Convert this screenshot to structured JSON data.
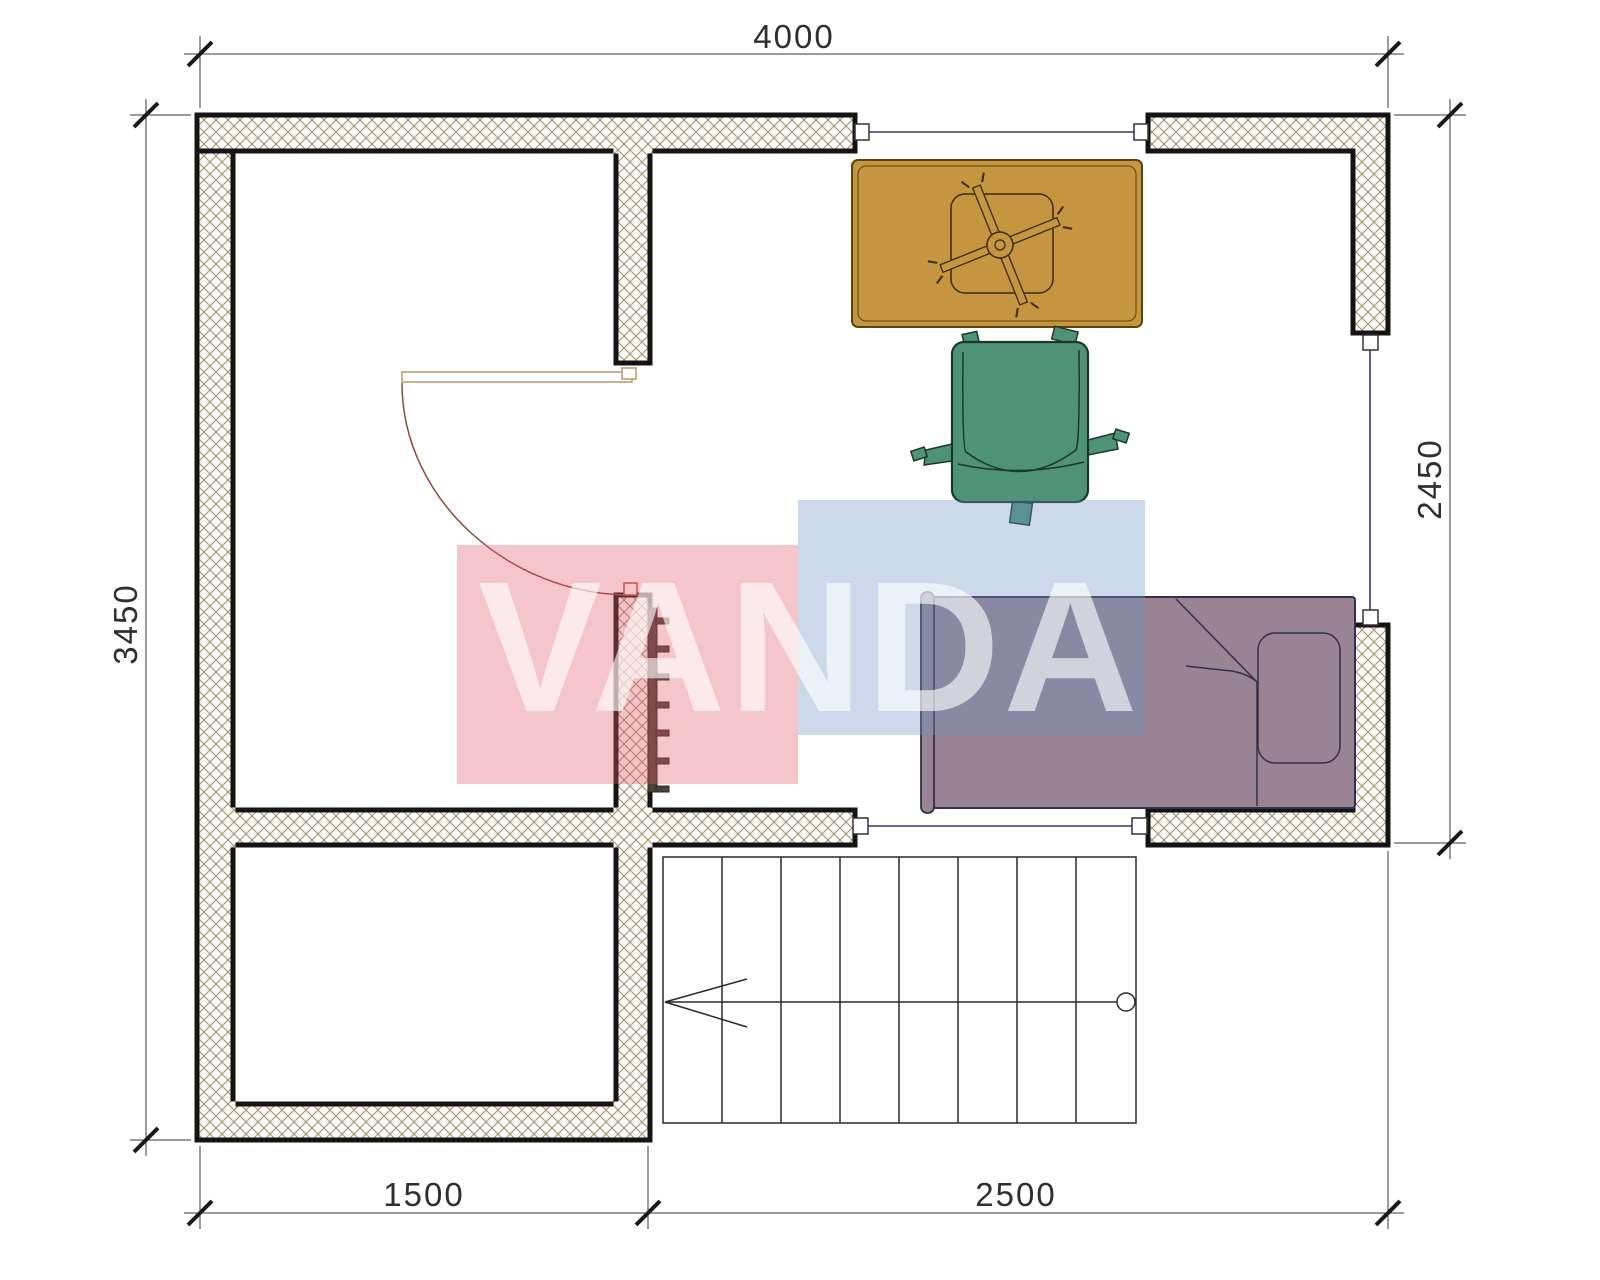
{
  "plan": {
    "type": "floor-plan",
    "dimensions": {
      "top": "4000",
      "left": "3450",
      "right": "2450",
      "bottom_left": "1500",
      "bottom_right": "2500"
    },
    "stairs": {
      "treads": 8
    },
    "windows_count": 3,
    "doors_count": 1,
    "furniture": [
      "desk",
      "office-chair",
      "armchair",
      "single-bed",
      "radiator",
      "staircase"
    ]
  },
  "watermark": {
    "text": "VANDA"
  },
  "colors": {
    "wall_line": "#141414",
    "hatch_line": "#a1906a",
    "hatch_bg": "#fbfaf6",
    "window_line": "#35356b",
    "frame_line": "#333333",
    "desk_fill": "#c6953f",
    "desk_line": "#5c430f",
    "chair_fill": "#4f9377",
    "chair_line": "#1c372b",
    "bed_fill": "#9a8494",
    "bed_line": "#33304a",
    "door_arc": "#8a4a3a",
    "door_leaf": "#b89868",
    "door_jamb": "#c0502a",
    "radiator": "#4a4238",
    "stair_line": "#2a2a2a",
    "dim_line": "#3a3a3a",
    "dim_text": "#2f2f2f",
    "wm_pink": "rgba(225,90,110,0.35)",
    "wm_blue": "rgba(109,146,195,0.35)",
    "wm_text": "rgba(255,255,255,0.62)"
  }
}
